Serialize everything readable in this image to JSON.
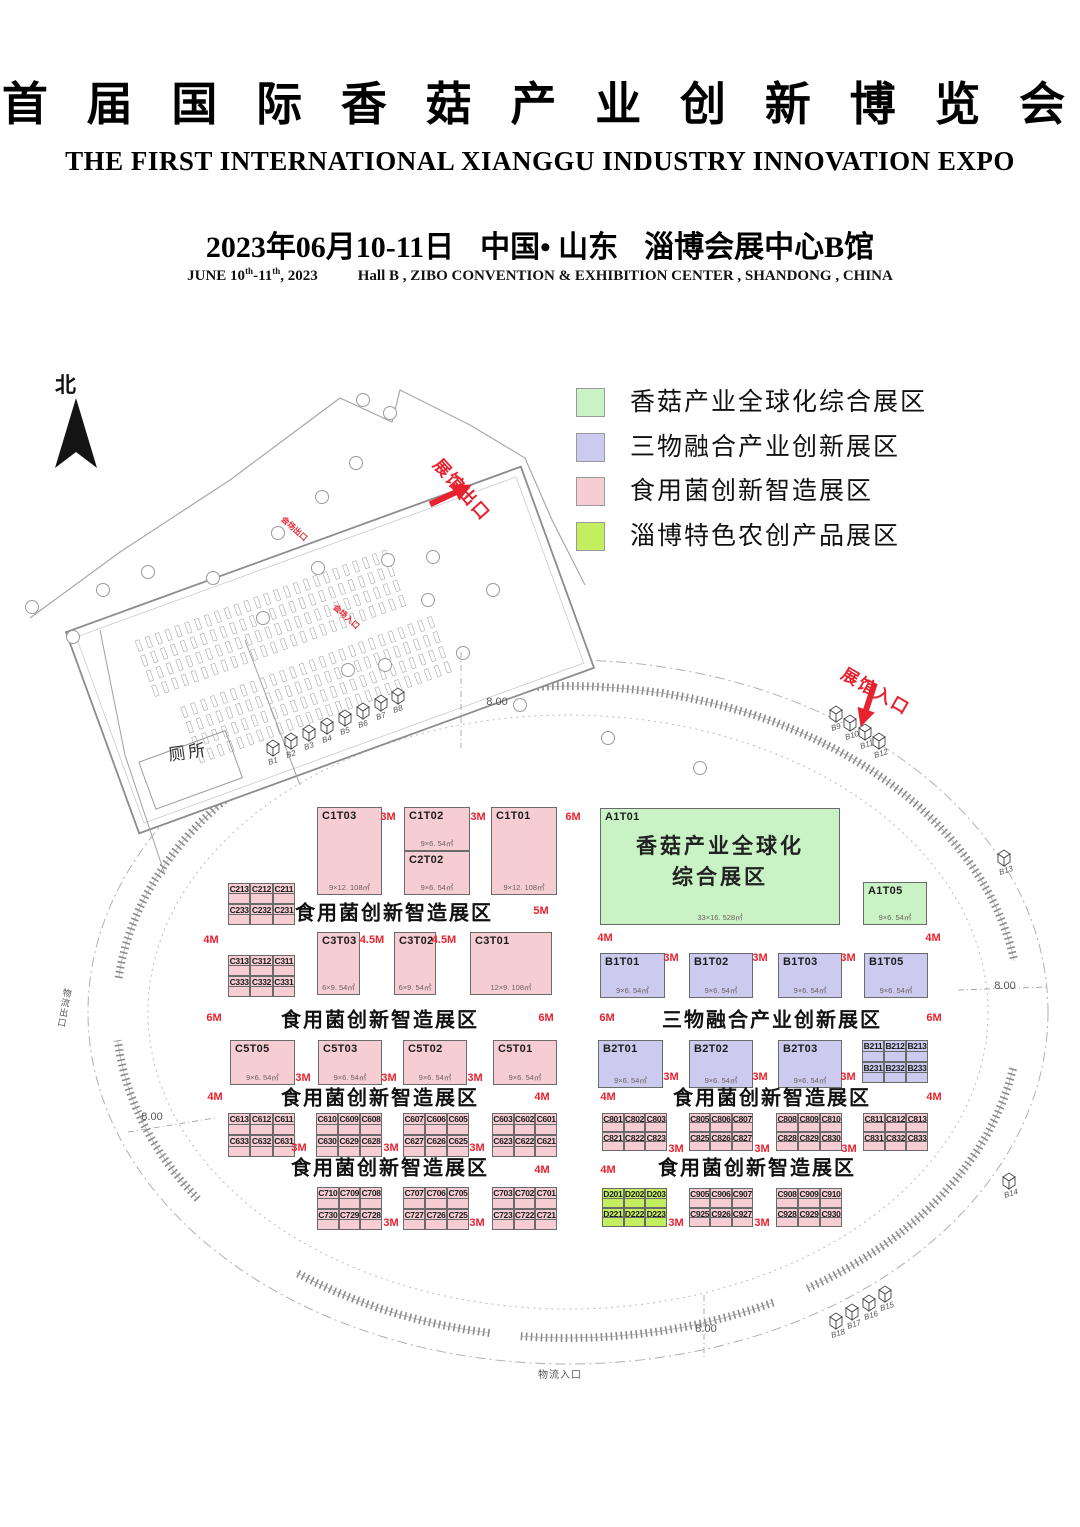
{
  "header": {
    "title_cn": "首 届 国 际 香 菇 产 业 创 新 博 览 会",
    "title_en": "THE FIRST INTERNATIONAL XIANGGU INDUSTRY INNOVATION EXPO",
    "date_cn": "2023年06月10-11日",
    "location_cn": "中国• 山东",
    "venue_cn": "淄博会展中心B馆",
    "date_en_a": "JUNE 10",
    "date_en_sup1": "th",
    "date_en_b": "-11",
    "date_en_sup2": "th",
    "date_en_c": ", 2023",
    "venue_en": "Hall B , ZIBO CONVENTION & EXHIBITION CENTER , SHANDONG , CHINA"
  },
  "colors": {
    "pink": "#f6cdd3",
    "purple": "#cccaee",
    "green": "#c9f3c5",
    "lime": "#c3ee5f",
    "red": "#e8212e",
    "wall": "#8a8a8a",
    "line": "#aaaaaa"
  },
  "legend": {
    "items": [
      {
        "label": "香菇产业全球化综合展区",
        "color": "green"
      },
      {
        "label": "三物融合产业创新展区",
        "color": "purple"
      },
      {
        "label": "食用菌创新智造展区",
        "color": "pink"
      },
      {
        "label": "淄博特色农创产品展区",
        "color": "lime"
      }
    ]
  },
  "plan": {
    "north_label": "北",
    "exit_label": "展馆出口",
    "entrance_label": "展馆入口",
    "toilet_label": "厕所",
    "logistics_exit_label": "物流出口",
    "logistics_entrance_label": "物流入口",
    "stage_exit_label": "会场出口",
    "stage_entrance_label": "会场入口",
    "big_booths": [
      {
        "id": "C1T03",
        "x": 317,
        "y": 807,
        "w": 65,
        "h": 88,
        "c": "pink",
        "dims": "9×12. 108㎡"
      },
      {
        "id": "C1T02",
        "x": 404,
        "y": 807,
        "w": 66,
        "h": 44,
        "c": "pink",
        "dims": "9×6. 54㎡"
      },
      {
        "id": "C2T02",
        "x": 404,
        "y": 851,
        "w": 66,
        "h": 44,
        "c": "pink",
        "dims": "9×6. 54㎡"
      },
      {
        "id": "C1T01",
        "x": 491,
        "y": 807,
        "w": 66,
        "h": 88,
        "c": "pink",
        "dims": "9×12. 108㎡"
      },
      {
        "id": "A1T01",
        "x": 600,
        "y": 808,
        "w": 240,
        "h": 117,
        "c": "green",
        "dims": "33×16. 528㎡",
        "name": [
          "香菇产业全球化",
          "综合展区"
        ]
      },
      {
        "id": "A1T05",
        "x": 863,
        "y": 882,
        "w": 64,
        "h": 43,
        "c": "green",
        "dims": "9×6. 54㎡"
      },
      {
        "id": "C3T03",
        "x": 317,
        "y": 932,
        "w": 43,
        "h": 63,
        "c": "pink",
        "dims": "6×9. 54㎡"
      },
      {
        "id": "C3T02",
        "x": 394,
        "y": 932,
        "w": 42,
        "h": 63,
        "c": "pink",
        "dims": "6×9. 54㎡"
      },
      {
        "id": "C3T01",
        "x": 470,
        "y": 932,
        "w": 82,
        "h": 63,
        "c": "pink",
        "dims": "12×9. 108㎡"
      },
      {
        "id": "B1T01",
        "x": 600,
        "y": 953,
        "w": 65,
        "h": 45,
        "c": "purple",
        "dims": "9×6. 54㎡"
      },
      {
        "id": "B1T02",
        "x": 689,
        "y": 953,
        "w": 64,
        "h": 45,
        "c": "purple",
        "dims": "9×6. 54㎡"
      },
      {
        "id": "B1T03",
        "x": 778,
        "y": 953,
        "w": 64,
        "h": 45,
        "c": "purple",
        "dims": "9×6. 54㎡"
      },
      {
        "id": "B1T05",
        "x": 864,
        "y": 953,
        "w": 64,
        "h": 45,
        "c": "purple",
        "dims": "9×6. 54㎡"
      },
      {
        "id": "C5T05",
        "x": 230,
        "y": 1040,
        "w": 65,
        "h": 45,
        "c": "pink",
        "dims": "9×6. 54㎡"
      },
      {
        "id": "C5T03",
        "x": 318,
        "y": 1040,
        "w": 64,
        "h": 45,
        "c": "pink",
        "dims": "9×6. 54㎡"
      },
      {
        "id": "C5T02",
        "x": 403,
        "y": 1040,
        "w": 64,
        "h": 45,
        "c": "pink",
        "dims": "9×6. 54㎡"
      },
      {
        "id": "C5T01",
        "x": 493,
        "y": 1040,
        "w": 64,
        "h": 45,
        "c": "pink",
        "dims": "9×6. 54㎡"
      },
      {
        "id": "B2T01",
        "x": 598,
        "y": 1040,
        "w": 65,
        "h": 48,
        "c": "purple",
        "dims": "9×6. 54㎡"
      },
      {
        "id": "B2T02",
        "x": 689,
        "y": 1040,
        "w": 64,
        "h": 48,
        "c": "purple",
        "dims": "9×6. 54㎡"
      },
      {
        "id": "B2T03",
        "x": 778,
        "y": 1040,
        "w": 64,
        "h": 48,
        "c": "purple",
        "dims": "9×6. 54㎡"
      }
    ],
    "groups": [
      {
        "x": 228,
        "y": 883,
        "w": 67,
        "h": 42,
        "c": "pink",
        "rows": [
          [
            "C213",
            "C212",
            "C211"
          ],
          [
            "C233",
            "C232",
            "C231"
          ]
        ]
      },
      {
        "x": 228,
        "y": 955,
        "w": 67,
        "h": 42,
        "c": "pink",
        "rows": [
          [
            "C313",
            "C312",
            "C311"
          ],
          [
            "C333",
            "C332",
            "C331"
          ]
        ]
      },
      {
        "x": 862,
        "y": 1040,
        "w": 66,
        "h": 43,
        "c": "purple",
        "rows": [
          [
            "B211",
            "B212",
            "B213"
          ],
          [
            "B231",
            "B232",
            "B233"
          ]
        ]
      },
      {
        "x": 228,
        "y": 1113,
        "w": 67,
        "h": 44,
        "c": "pink",
        "rows": [
          [
            "C613",
            "C612",
            "C611"
          ],
          [
            "C633",
            "C632",
            "C631"
          ]
        ]
      },
      {
        "x": 316,
        "y": 1113,
        "w": 66,
        "h": 44,
        "c": "pink",
        "rows": [
          [
            "C610",
            "C609",
            "C608"
          ],
          [
            "C630",
            "C629",
            "C628"
          ]
        ]
      },
      {
        "x": 403,
        "y": 1113,
        "w": 66,
        "h": 44,
        "c": "pink",
        "rows": [
          [
            "C607",
            "C606",
            "C605"
          ],
          [
            "C627",
            "C626",
            "C625"
          ]
        ]
      },
      {
        "x": 492,
        "y": 1113,
        "w": 65,
        "h": 44,
        "c": "pink",
        "rows": [
          [
            "C603",
            "C602",
            "C601"
          ],
          [
            "C623",
            "C622",
            "C621"
          ]
        ]
      },
      {
        "x": 602,
        "y": 1113,
        "w": 65,
        "h": 38,
        "c": "pink",
        "rows": [
          [
            "C801",
            "C802",
            "C803"
          ],
          [
            "C821",
            "C822",
            "C823"
          ]
        ]
      },
      {
        "x": 689,
        "y": 1113,
        "w": 64,
        "h": 38,
        "c": "pink",
        "rows": [
          [
            "C805",
            "C806",
            "C807"
          ],
          [
            "C825",
            "C826",
            "C827"
          ]
        ]
      },
      {
        "x": 776,
        "y": 1113,
        "w": 66,
        "h": 38,
        "c": "pink",
        "rows": [
          [
            "C808",
            "C809",
            "C810"
          ],
          [
            "C828",
            "C829",
            "C830"
          ]
        ]
      },
      {
        "x": 863,
        "y": 1113,
        "w": 65,
        "h": 38,
        "c": "pink",
        "rows": [
          [
            "C811",
            "C812",
            "C813"
          ],
          [
            "C831",
            "C832",
            "C833"
          ]
        ]
      },
      {
        "x": 317,
        "y": 1187,
        "w": 65,
        "h": 43,
        "c": "pink",
        "rows": [
          [
            "C710",
            "C709",
            "C708"
          ],
          [
            "C730",
            "C729",
            "C728"
          ]
        ]
      },
      {
        "x": 403,
        "y": 1187,
        "w": 66,
        "h": 43,
        "c": "pink",
        "rows": [
          [
            "C707",
            "C706",
            "C705"
          ],
          [
            "C727",
            "C726",
            "C725"
          ]
        ]
      },
      {
        "x": 492,
        "y": 1187,
        "w": 65,
        "h": 43,
        "c": "pink",
        "rows": [
          [
            "C703",
            "C702",
            "C701"
          ],
          [
            "C723",
            "C722",
            "C721"
          ]
        ]
      },
      {
        "x": 602,
        "y": 1188,
        "w": 65,
        "h": 39,
        "c": "lime",
        "rows": [
          [
            "D201",
            "D202",
            "D203"
          ],
          [
            "D221",
            "D222",
            "D223"
          ]
        ]
      },
      {
        "x": 689,
        "y": 1188,
        "w": 64,
        "h": 39,
        "c": "pink",
        "rows": [
          [
            "C905",
            "C906",
            "C907"
          ],
          [
            "C925",
            "C926",
            "C927"
          ]
        ]
      },
      {
        "x": 776,
        "y": 1188,
        "w": 66,
        "h": 39,
        "c": "pink",
        "rows": [
          [
            "C908",
            "C909",
            "C910"
          ],
          [
            "C928",
            "C929",
            "C930"
          ]
        ]
      }
    ],
    "zone_labels": [
      {
        "t": "食用菌创新智造展区",
        "x": 394,
        "y": 911
      },
      {
        "t": "食用菌创新智造展区",
        "x": 380,
        "y": 1018
      },
      {
        "t": "三物融合产业创新展区",
        "x": 772,
        "y": 1018
      },
      {
        "t": "食用菌创新智造展区",
        "x": 380,
        "y": 1096
      },
      {
        "t": "食用菌创新智造展区",
        "x": 772,
        "y": 1096
      },
      {
        "t": "食用菌创新智造展区",
        "x": 390,
        "y": 1166
      },
      {
        "t": "食用菌创新智造展区",
        "x": 757,
        "y": 1166
      }
    ],
    "aisle_labels": [
      {
        "t": "3M",
        "x": 388,
        "y": 817
      },
      {
        "t": "3M",
        "x": 478,
        "y": 817
      },
      {
        "t": "6M",
        "x": 573,
        "y": 817
      },
      {
        "t": "5M",
        "x": 541,
        "y": 911
      },
      {
        "t": "4M",
        "x": 211,
        "y": 940
      },
      {
        "t": "4.5M",
        "x": 372,
        "y": 940
      },
      {
        "t": "4.5M",
        "x": 444,
        "y": 940
      },
      {
        "t": "4M",
        "x": 605,
        "y": 938
      },
      {
        "t": "4M",
        "x": 933,
        "y": 938
      },
      {
        "t": "6M",
        "x": 214,
        "y": 1018
      },
      {
        "t": "6M",
        "x": 546,
        "y": 1018
      },
      {
        "t": "6M",
        "x": 607,
        "y": 1018
      },
      {
        "t": "6M",
        "x": 934,
        "y": 1018
      },
      {
        "t": "3M",
        "x": 671,
        "y": 958
      },
      {
        "t": "3M",
        "x": 760,
        "y": 958
      },
      {
        "t": "3M",
        "x": 848,
        "y": 958
      },
      {
        "t": "3M",
        "x": 303,
        "y": 1078
      },
      {
        "t": "3M",
        "x": 389,
        "y": 1078
      },
      {
        "t": "3M",
        "x": 475,
        "y": 1078
      },
      {
        "t": "3M",
        "x": 671,
        "y": 1077
      },
      {
        "t": "3M",
        "x": 760,
        "y": 1077
      },
      {
        "t": "3M",
        "x": 848,
        "y": 1077
      },
      {
        "t": "4M",
        "x": 215,
        "y": 1097
      },
      {
        "t": "4M",
        "x": 542,
        "y": 1097
      },
      {
        "t": "4M",
        "x": 608,
        "y": 1097
      },
      {
        "t": "4M",
        "x": 934,
        "y": 1097
      },
      {
        "t": "3M",
        "x": 299,
        "y": 1148
      },
      {
        "t": "3M",
        "x": 391,
        "y": 1148
      },
      {
        "t": "3M",
        "x": 477,
        "y": 1148
      },
      {
        "t": "3M",
        "x": 676,
        "y": 1149
      },
      {
        "t": "3M",
        "x": 762,
        "y": 1149
      },
      {
        "t": "3M",
        "x": 849,
        "y": 1149
      },
      {
        "t": "4M",
        "x": 542,
        "y": 1170
      },
      {
        "t": "4M",
        "x": 608,
        "y": 1170
      },
      {
        "t": "3M",
        "x": 391,
        "y": 1223
      },
      {
        "t": "3M",
        "x": 477,
        "y": 1223
      },
      {
        "t": "3M",
        "x": 676,
        "y": 1223
      },
      {
        "t": "3M",
        "x": 762,
        "y": 1223
      }
    ],
    "dim_labels": [
      {
        "t": "8.00",
        "x": 497,
        "y": 702
      },
      {
        "t": "8.00",
        "x": 152,
        "y": 1117
      },
      {
        "t": "8.00",
        "x": 1005,
        "y": 986
      },
      {
        "t": "8.00",
        "x": 706,
        "y": 1329
      }
    ],
    "cube_markers": [
      {
        "label": "B1",
        "x": 273,
        "y": 747
      },
      {
        "label": "B2",
        "x": 291,
        "y": 740
      },
      {
        "label": "B3",
        "x": 309,
        "y": 732
      },
      {
        "label": "B4",
        "x": 327,
        "y": 725
      },
      {
        "label": "B5",
        "x": 345,
        "y": 717
      },
      {
        "label": "B6",
        "x": 363,
        "y": 710
      },
      {
        "label": "B7",
        "x": 381,
        "y": 702
      },
      {
        "label": "B8",
        "x": 398,
        "y": 695
      },
      {
        "label": "B9",
        "x": 836,
        "y": 713
      },
      {
        "label": "B10",
        "x": 850,
        "y": 722
      },
      {
        "label": "B11",
        "x": 865,
        "y": 731
      },
      {
        "label": "B12",
        "x": 879,
        "y": 740
      },
      {
        "label": "B13",
        "x": 1004,
        "y": 857
      },
      {
        "label": "B14",
        "x": 1009,
        "y": 1180
      },
      {
        "label": "B18",
        "x": 836,
        "y": 1320
      },
      {
        "label": "B17",
        "x": 852,
        "y": 1311
      },
      {
        "label": "B16",
        "x": 869,
        "y": 1302
      },
      {
        "label": "B15",
        "x": 885,
        "y": 1293
      }
    ]
  }
}
